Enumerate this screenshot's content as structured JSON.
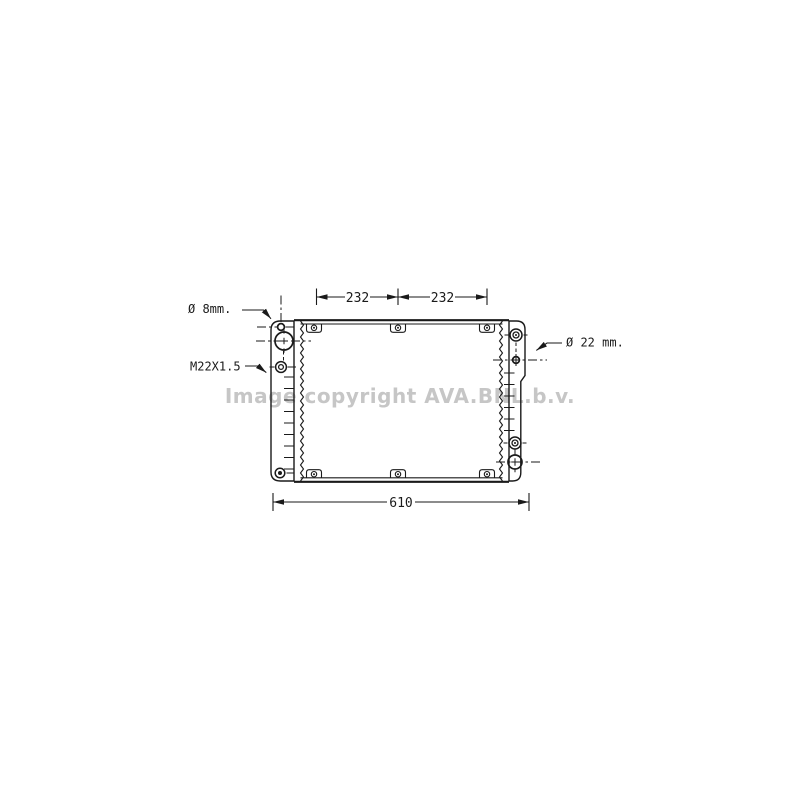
{
  "watermark": {
    "text": "Image copyright AVA.BNL.b.v.",
    "color": "#c6c6c6"
  },
  "labels": {
    "small_hole": "Ø 8mm.",
    "thread": "M22X1.5",
    "outlet": "Ø 22 mm."
  },
  "dimensions": {
    "top_left_span": "232",
    "top_right_span": "232",
    "overall_width": "610"
  },
  "colors": {
    "ink": "#1a1a1a",
    "background": "#ffffff"
  }
}
